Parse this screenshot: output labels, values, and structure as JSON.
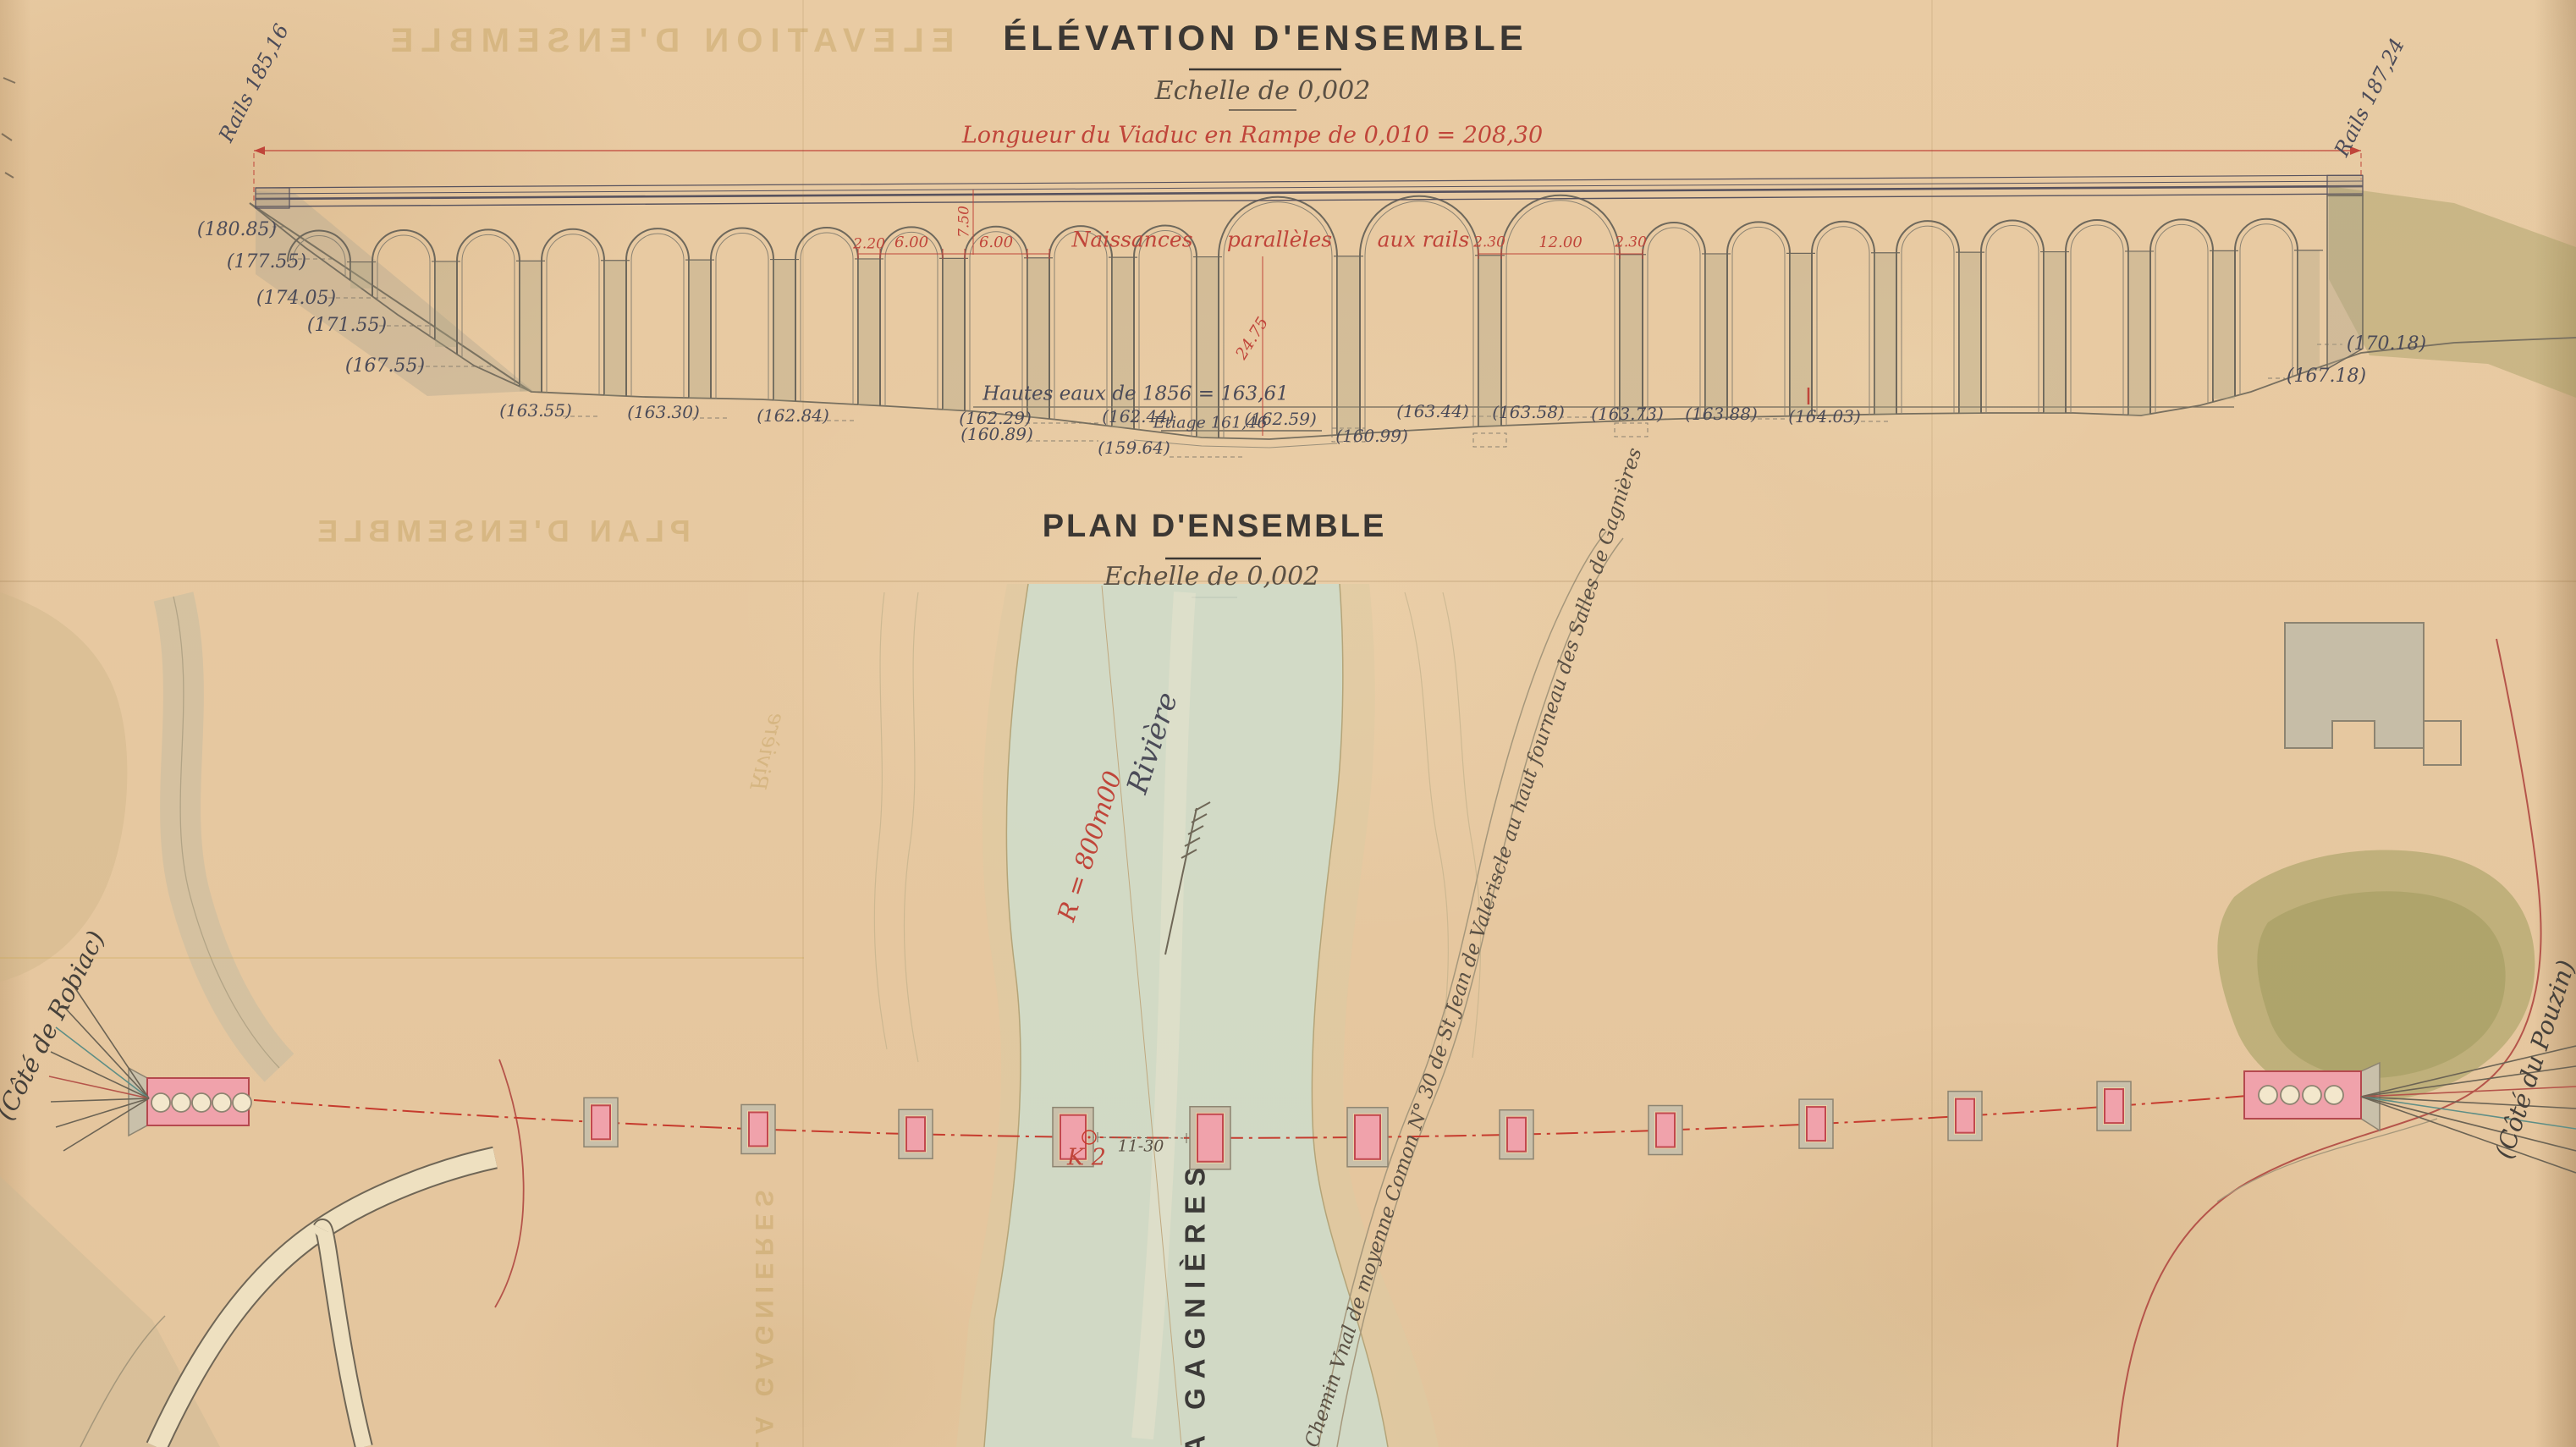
{
  "palette": {
    "paper": "#e9cba3",
    "ink_dark": "#3b3733",
    "ink_blue": "#4b4b58",
    "ink_sepia": "#5a5044",
    "ink_red": "#c0453a",
    "wash_gray": "#b7ab93",
    "wash_olive": "#9f9c60",
    "wash_water": "#ccdfd2",
    "pier_pink": "#f0a2ab"
  },
  "elevation": {
    "title": "ÉLÉVATION D'ENSEMBLE",
    "scale_label": "Echelle de 0,002",
    "length_note": "Longueur du Viaduc en Rampe de 0,010 = 208,30",
    "rail_level_left": "Rails 185,16",
    "rail_level_right": "Rails 187,24",
    "springing_note": {
      "w1": "Naissances",
      "w2": "parallèles",
      "w3": "aux rails"
    },
    "dims": {
      "d1": "2.20",
      "d2": "6.00",
      "d3": "6.00",
      "d4": "2.30",
      "d5": "12.00",
      "d6": "2.30",
      "v1": "7.50",
      "v2": "24.75"
    },
    "high_water": "Hautes eaux de 1856 = 163,61",
    "low_water": "Etiage 161,46",
    "levels_left": [
      "(180.85)",
      "(177.55)",
      "(174.05)",
      "(171.55)",
      "(167.55)"
    ],
    "levels_right": [
      "(170.18)",
      "(167.18)"
    ],
    "levels_bottom": [
      "(163.55)",
      "(163.30)",
      "(162.84)",
      "(162.29)",
      "(160.89)",
      "(162.44)",
      "(159.64)",
      "(162.59)",
      "(160.99)",
      "(163.44)",
      "(163.58)",
      "(163.73)",
      "(163.88)",
      "(164.03)"
    ]
  },
  "plan": {
    "title": "PLAN D'ENSEMBLE",
    "scale_label": "Echelle de 0,002",
    "river_name": "LA GAGNIÈRES",
    "river_word": "Rivière",
    "curve_radius": "R = 800m00",
    "km_marker": "K 2",
    "km_offset": "11-30",
    "road_label": "Chemin Vnal de moyenne Comon N° 30 de St Jean de Valériscle au haut fourneau des Salles de Gagnières",
    "side_left": "(Côté de Robiac)",
    "side_right": "(Côté du Pouzin)"
  },
  "bleedthrough": {
    "elevation_title": "ELEVATION D'ENSEMBLE",
    "plan_title": "PLAN D'ENSEMBLE",
    "river_name": "LA GAGNIERES",
    "river_word": "Rivière"
  }
}
